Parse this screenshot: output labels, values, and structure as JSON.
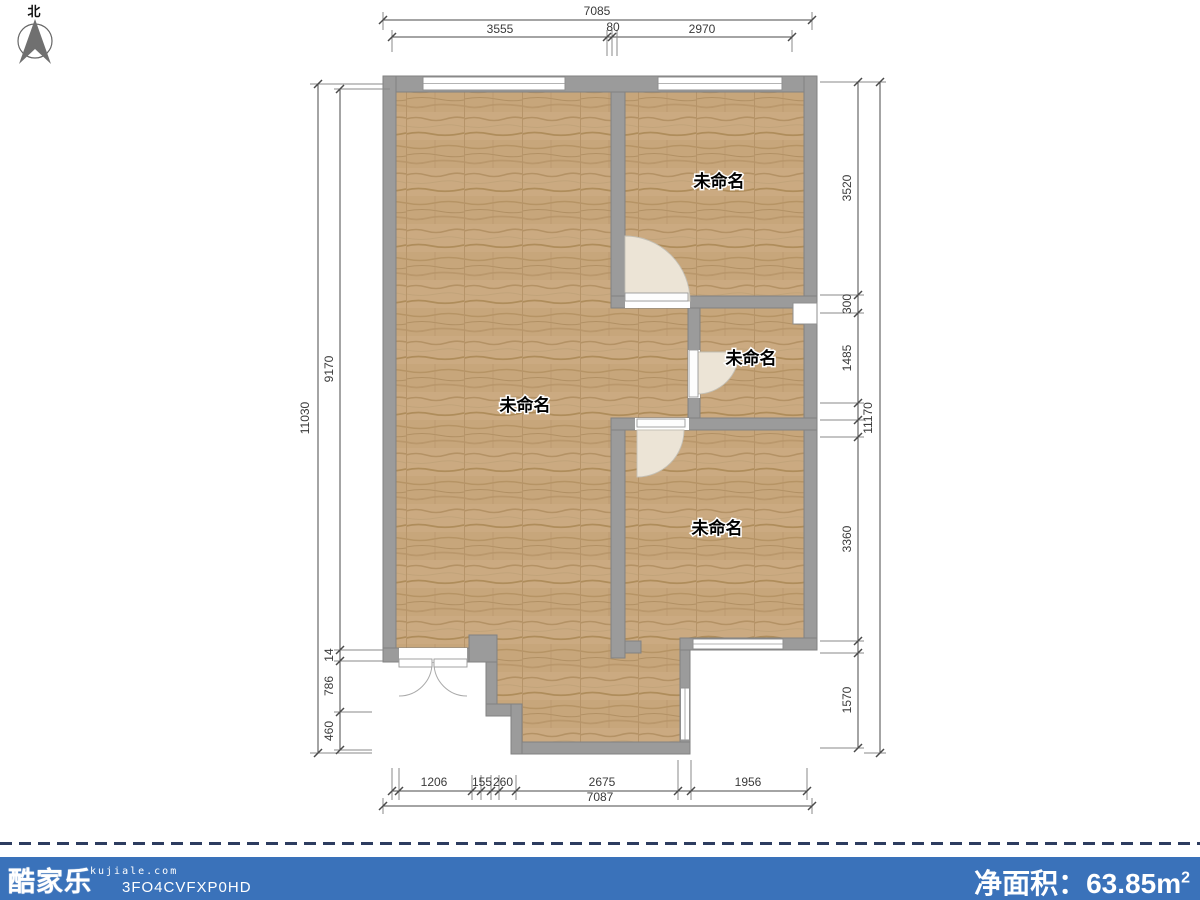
{
  "compass": {
    "north_label": "北"
  },
  "rooms": [
    {
      "label": "未命名"
    },
    {
      "label": "未命名"
    },
    {
      "label": "未命名"
    },
    {
      "label": "未命名"
    }
  ],
  "dimensions": {
    "top": {
      "overall": "7085",
      "segments": [
        "3555",
        "80",
        "2970"
      ]
    },
    "bottom": {
      "overall": "7087",
      "segments": [
        "1206",
        "155",
        "260",
        "2675",
        "1956"
      ]
    },
    "left": {
      "overall": "11030",
      "segments": [
        "9170",
        "14",
        "786",
        "460"
      ]
    },
    "right": {
      "overall": "11170",
      "segments": [
        "3520",
        "300",
        "1485",
        "3360",
        "1570"
      ]
    }
  },
  "footer": {
    "brand": "酷家乐",
    "website": "kujiale.com",
    "plan_code": "3FO4CVFXP0HD",
    "area_label": "净面积：",
    "area_value": "63.85",
    "area_unit_base": "m",
    "area_unit_exp": "2"
  },
  "colors": {
    "footer_blue": "#3a72ba",
    "wall_gray": "#9b9b9b",
    "floor_wood": "#c9a87d",
    "dashed_line": "#2d3c5f"
  }
}
